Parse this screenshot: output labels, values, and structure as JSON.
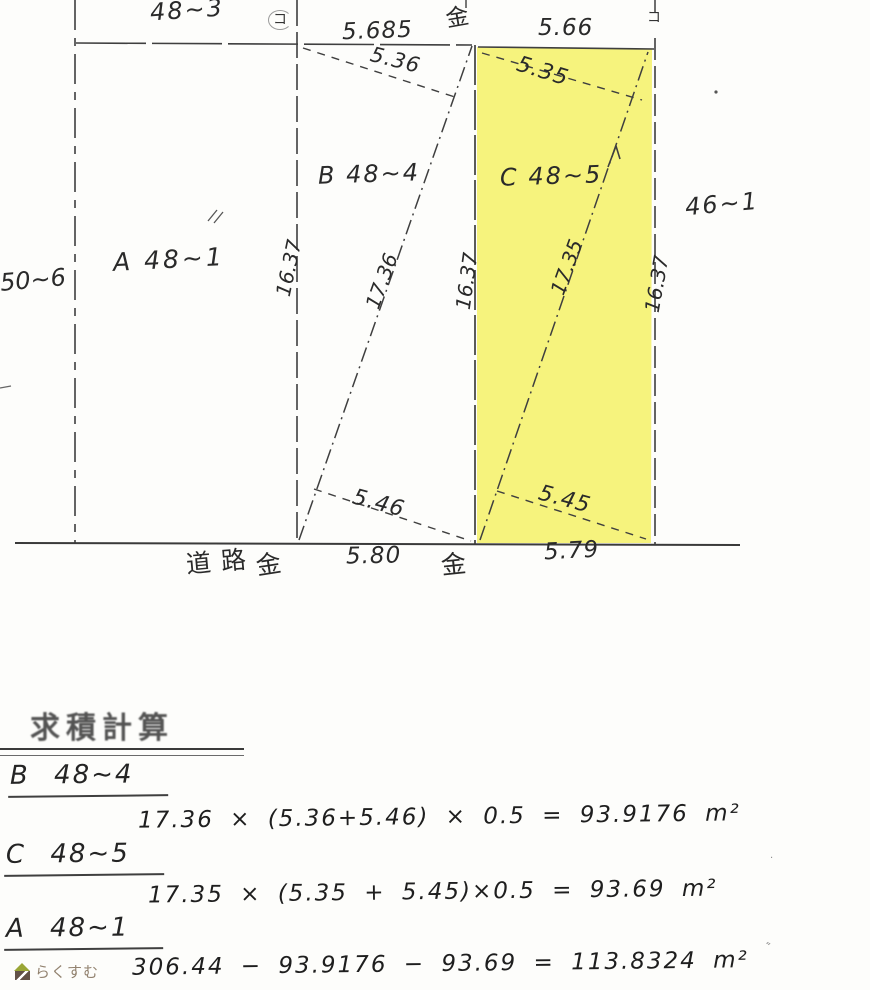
{
  "map": {
    "highlight_color": "#f6f37d",
    "parcels": {
      "a_label": "A 48~1",
      "b_label": "B 48~4",
      "c_label": "C 48~5",
      "north_label": "48~3",
      "west_label": "50~6",
      "east_label": "46~1"
    },
    "dims": {
      "top_b": "5.685",
      "top_c": "5.66",
      "upper_b": "5.36",
      "upper_c": "5.35",
      "lower_b": "5.46",
      "lower_c": "5.45",
      "bottom_b": "5.80",
      "bottom_c": "5.79",
      "depth": "16.37",
      "diag_b": "17.36",
      "diag_c": "17.35"
    },
    "marks": {
      "kane": "金",
      "ko": "コ",
      "road": "道路"
    }
  },
  "calc": {
    "title": "求積計算",
    "blocks": [
      {
        "heading": "B 48~4",
        "formula": "17.36 × (5.36+5.46) × 0.5 = 93.9176 m²"
      },
      {
        "heading": "C 48~5",
        "formula": "17.35 × (5.35 + 5.45)×0.5 = 93.69 m²"
      },
      {
        "heading": "A 48~1",
        "formula": "306.44 − 93.9176 − 93.69 = 113.8324 m²"
      }
    ]
  },
  "logo": {
    "text": "らくすむ"
  }
}
